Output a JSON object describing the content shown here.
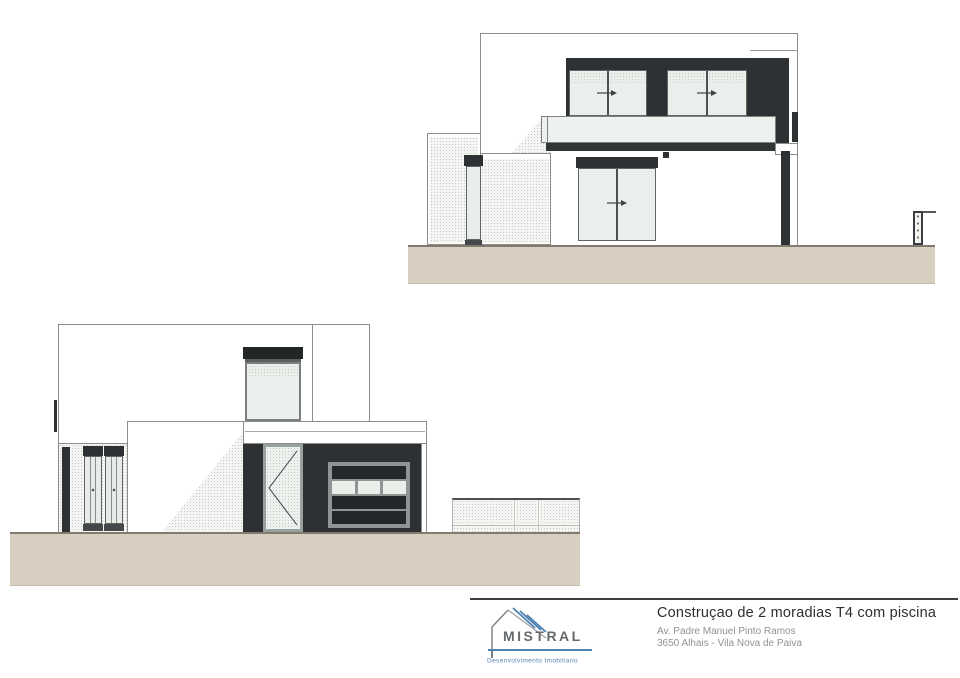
{
  "title_block": {
    "project_title": "Construçao de 2 moradias T4 com piscina",
    "address_line1": "Av. Padre Manuel Pinto Ramos",
    "address_line2": "3650 Alhais - Vila Nova de Paiva",
    "logo": {
      "name": "MISTRAL",
      "tagline": "Desenvolvimento Imobiliario",
      "icon": "house-roof-icon",
      "blue": "#4d82b0",
      "gray": "#66696c"
    }
  },
  "palette": {
    "ground": "#d8cfc0",
    "cladding_dark": "#2d3133",
    "glass": "#eaefec",
    "balcony_glass": "#edf2ef",
    "outline_gray": "#8c8c8a",
    "title_text": "#2e2e2e",
    "address_text": "#909294"
  }
}
